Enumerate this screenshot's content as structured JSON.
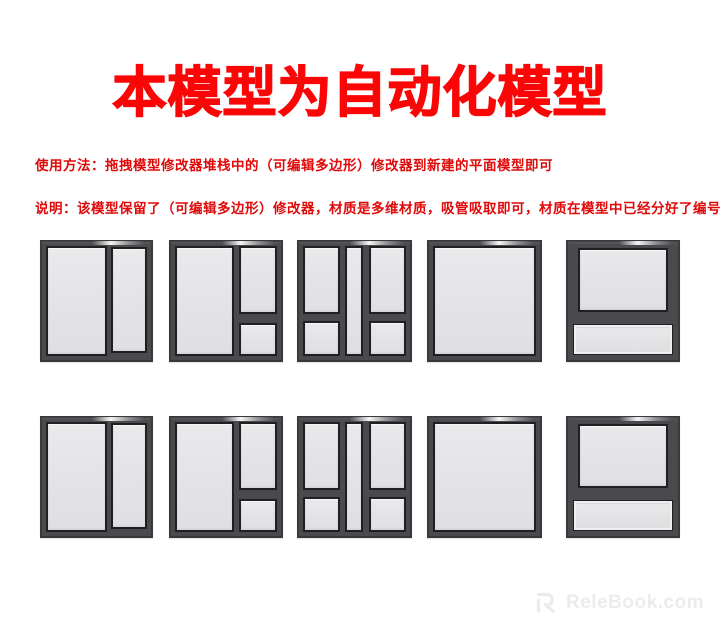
{
  "title": "本模型为自动化模型",
  "instructions": {
    "usage": "使用方法：拖拽模型修改器堆栈中的（可编辑多边形）修改器到新建的平面模型即可",
    "note": "说明：该模型保留了（可编辑多边形）修改器，材质是多维材质，吸管吸取即可，材质在模型中已经分好了编号。"
  },
  "windows": {
    "rows": [
      {
        "items": [
          {
            "type": "A",
            "name": "window-two-pane"
          },
          {
            "type": "B",
            "name": "window-right-column-split"
          },
          {
            "type": "C",
            "name": "window-double-column-center-strip"
          },
          {
            "type": "D",
            "name": "window-single-pane"
          },
          {
            "type": "E",
            "name": "window-top-sash-bottom-transom"
          }
        ]
      },
      {
        "items": [
          {
            "type": "A",
            "name": "window-two-pane"
          },
          {
            "type": "B",
            "name": "window-right-column-split"
          },
          {
            "type": "C",
            "name": "window-double-column-center-strip"
          },
          {
            "type": "D",
            "name": "window-single-pane"
          },
          {
            "type": "E",
            "name": "window-top-sash-bottom-transom"
          }
        ]
      }
    ]
  },
  "watermark": {
    "logo_icon": "relebook-logo",
    "text": "ReleBook.com"
  },
  "colors": {
    "red_title": "#fb0606",
    "red_text": "#e00909",
    "frame": "#4a4a4e",
    "frame_dark": "#202022",
    "glass": "#e3e3e5",
    "watermark": "#ececec"
  }
}
